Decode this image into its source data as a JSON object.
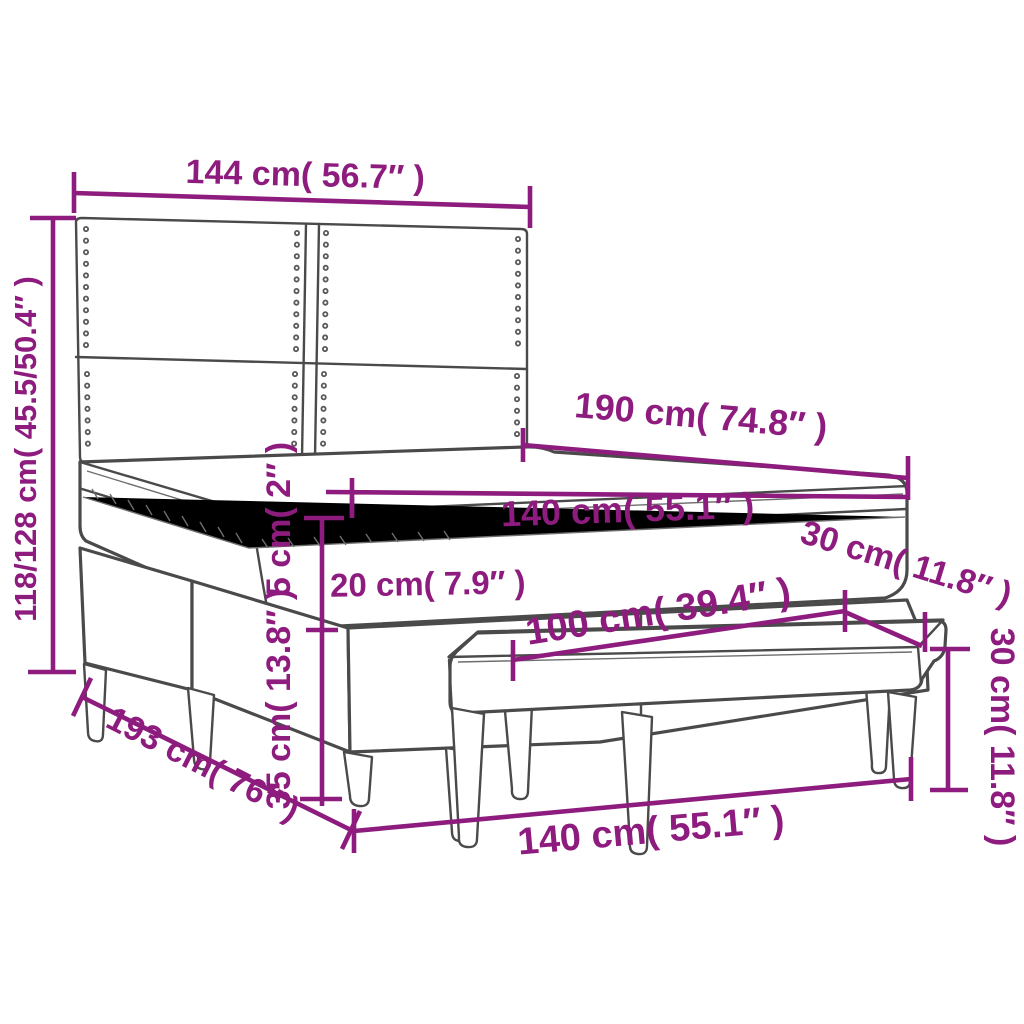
{
  "title": "Box spring bed with headboard, topper and bench – dimension diagram",
  "colors": {
    "dimension_text": "#8E1C7E",
    "furniture_outline": "#4a4a4a",
    "background": "#ffffff"
  },
  "dimensions": {
    "headboard_width": "144 cm( 56.7″ )",
    "total_height": "118/128 cm( 45.5/50.4″ )",
    "mattress_length": "190 cm( 74.8″ )",
    "mattress_width": "140 cm( 55.1″ )",
    "topper_thickness": "5 cm( 2″ )",
    "mattress_thickness": "20 cm( 7.9″ )",
    "base_height": "35 cm( 13.8″ )",
    "bench_depth": "30 cm( 11.8″ )",
    "bench_length": "100 cm( 39.4″ )",
    "bench_height": "30 cm( 11.8″ )",
    "bed_total_length": "193 cm( 76″ )",
    "bed_width_front": "140 cm( 55.1″ )"
  }
}
